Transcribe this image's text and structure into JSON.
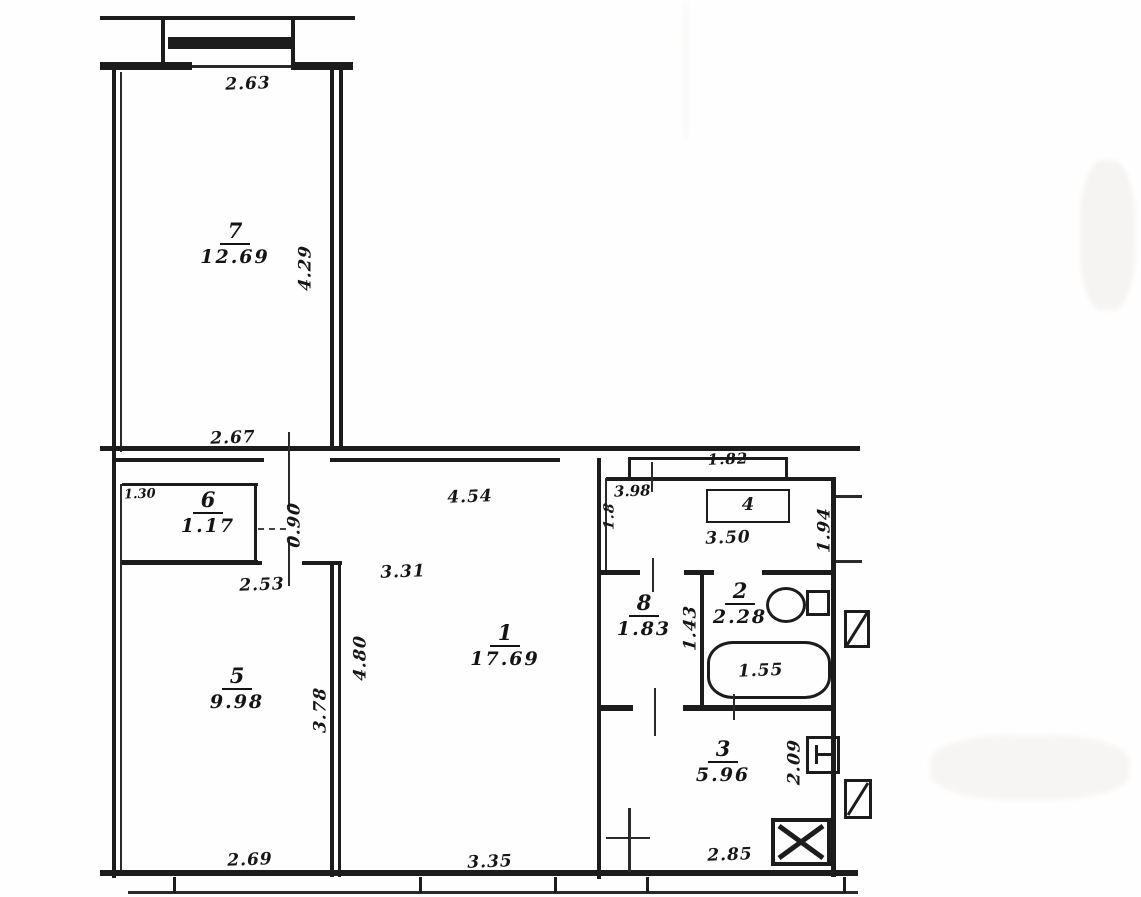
{
  "plan": {
    "title": "apartment-floor-plan-scan",
    "rooms": {
      "r7": {
        "number": "7",
        "area": "12.69"
      },
      "r6": {
        "number": "6",
        "area": "1.17"
      },
      "r5": {
        "number": "5",
        "area": "9.98"
      },
      "r1": {
        "number": "1",
        "area": "17.69"
      },
      "r4": {
        "number": "4",
        "area": "3.50"
      },
      "r8": {
        "number": "8",
        "area": "1.83"
      },
      "r2": {
        "number": "2",
        "area": "2.28"
      },
      "r3": {
        "number": "3",
        "area": "5.96"
      }
    },
    "dims": {
      "room7_top": "2.63",
      "room7_right": "4.29",
      "room7_bottom": "2.67",
      "room6_width": "1.30",
      "entry_door": "0.90",
      "room5_top": "2.53",
      "room5_right": "3.78",
      "room5_bottom": "2.69",
      "corridor_left": "4.80",
      "room1_top": "4.54",
      "room1_inner": "3.31",
      "room1_bottom": "3.35",
      "hall_niche": "1.82",
      "hall_top": "3.98",
      "hall_left": "1.8",
      "hall_right": "1.94",
      "wc_right": "1.43",
      "tub_length": "1.55",
      "kitchen_right": "2.09",
      "kitchen_bottom": "2.85"
    }
  }
}
